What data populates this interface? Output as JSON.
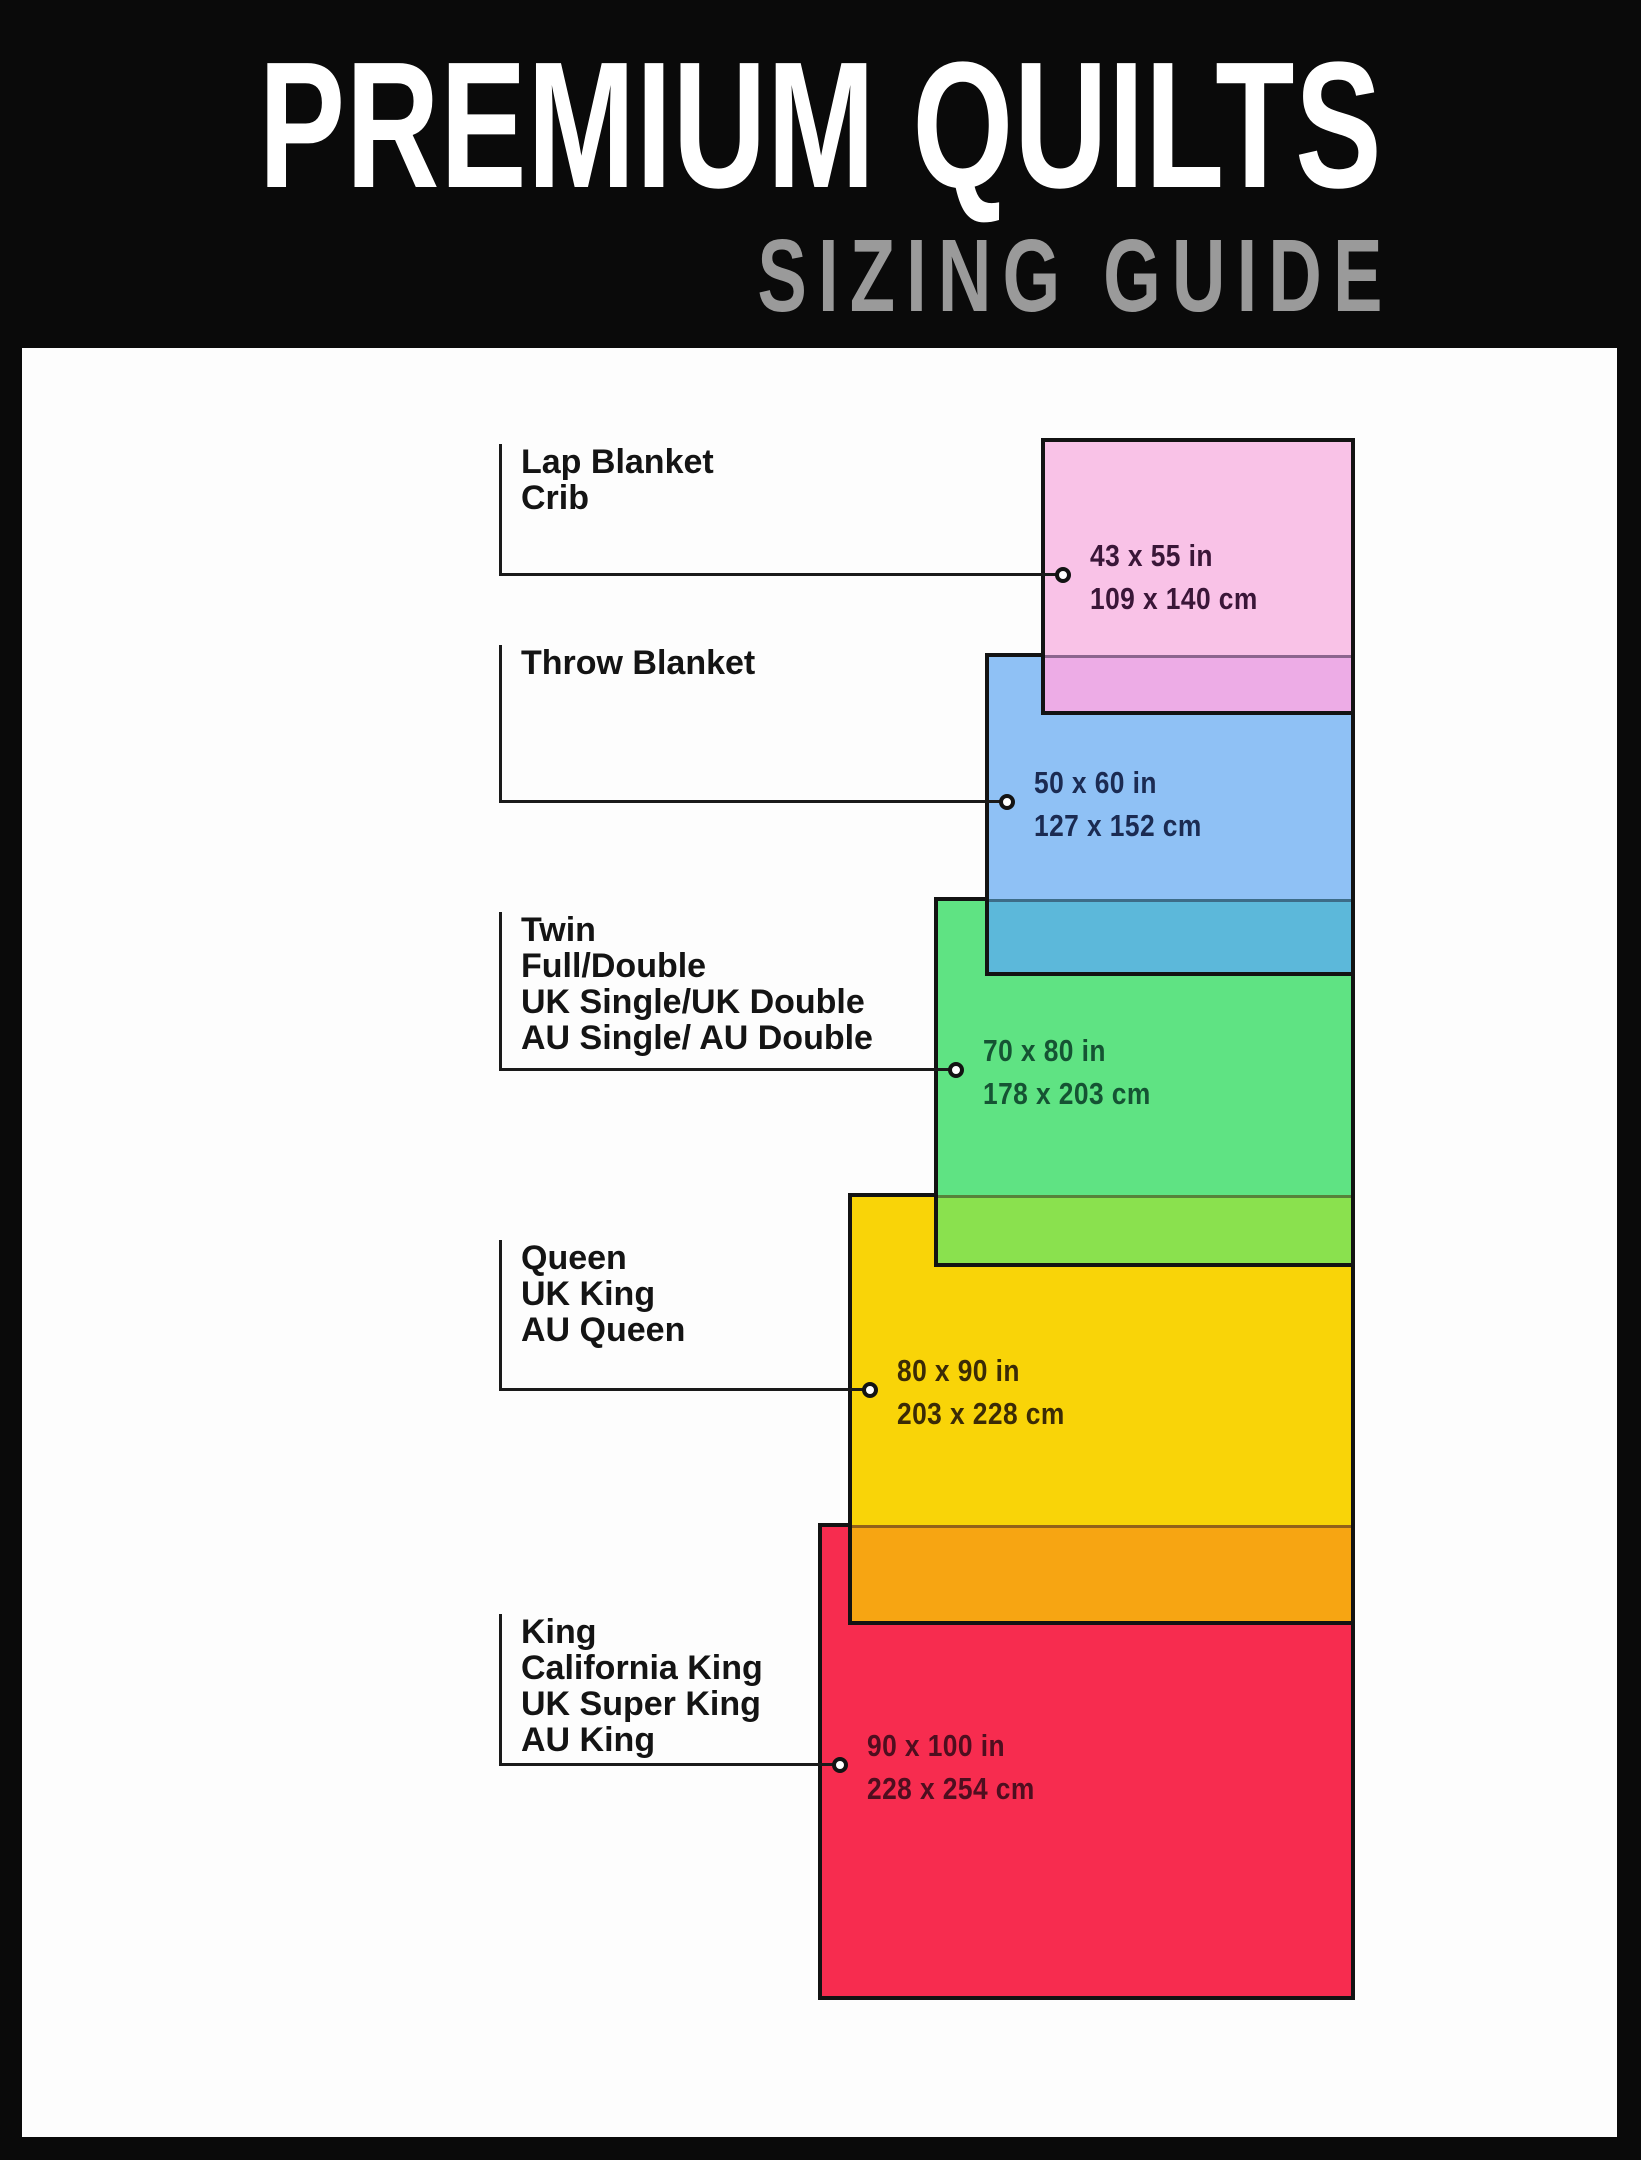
{
  "header": {
    "title": "PREMIUM QUILTS",
    "subtitle": "SIZING GUIDE"
  },
  "colors": {
    "page_bg": "#0A0A0A",
    "panel_bg": "#FDFDFD",
    "connector_line": "#1A1A1A",
    "label_text": "#141414",
    "title_text": "#FFFFFF",
    "subtitle_text": "#9A9A9A"
  },
  "panel": {
    "left": 22,
    "top": 348,
    "width": 1595,
    "height": 1789
  },
  "layout": {
    "label_line_x": 499,
    "label_text_x": 521,
    "rect_right": 1355
  },
  "sizes": [
    {
      "id": "lap-blanket-crib",
      "labels": [
        "Lap Blanket",
        "Crib"
      ],
      "inches": "43 x 55 in",
      "cm": "109 x 140 cm",
      "fill": "#F9C2E7",
      "overlap_fill": "#EDACE6",
      "text_color": "#3A1638",
      "rect": {
        "left": 1041,
        "top": 438,
        "width": 314,
        "height": 277
      },
      "label_top": 444,
      "connector_y": 573,
      "dot_x": 1063
    },
    {
      "id": "throw-blanket",
      "labels": [
        "Throw Blanket"
      ],
      "inches": "50 x 60 in",
      "cm": "127 x 152 cm",
      "fill": "#8FC1F5",
      "overlap_fill": "#5CB8DA",
      "text_color": "#1B2B52",
      "rect": {
        "left": 985,
        "top": 653,
        "width": 370,
        "height": 323
      },
      "label_top": 645,
      "connector_y": 800,
      "dot_x": 1007
    },
    {
      "id": "twin-full-double",
      "labels": [
        "Twin",
        "Full/Double",
        "UK Single/UK Double",
        "AU Single/ AU Double"
      ],
      "inches": "70 x 80 in",
      "cm": "178 x 203 cm",
      "fill": "#5FE383",
      "overlap_fill": "#8AE14E",
      "text_color": "#155333",
      "rect": {
        "left": 934,
        "top": 897,
        "width": 421,
        "height": 370
      },
      "label_top": 912,
      "connector_y": 1068,
      "dot_x": 956
    },
    {
      "id": "queen-uk-king-au-queen",
      "labels": [
        "Queen",
        "UK King",
        "AU Queen"
      ],
      "inches": "80 x 90 in",
      "cm": "203 x 228 cm",
      "fill": "#F9D408",
      "overlap_fill": "#F7A512",
      "text_color": "#3B2B06",
      "rect": {
        "left": 848,
        "top": 1193,
        "width": 507,
        "height": 432
      },
      "label_top": 1240,
      "connector_y": 1388,
      "dot_x": 870
    },
    {
      "id": "king-california-king",
      "labels": [
        "King",
        "California King",
        "UK Super King",
        "AU King"
      ],
      "inches": "90 x 100 in",
      "cm": "228 x 254 cm",
      "fill": "#F72C4F",
      "overlap_fill": null,
      "text_color": "#4E0E1F",
      "rect": {
        "left": 818,
        "top": 1523,
        "width": 537,
        "height": 477
      },
      "label_top": 1614,
      "connector_y": 1763,
      "dot_x": 840
    }
  ]
}
